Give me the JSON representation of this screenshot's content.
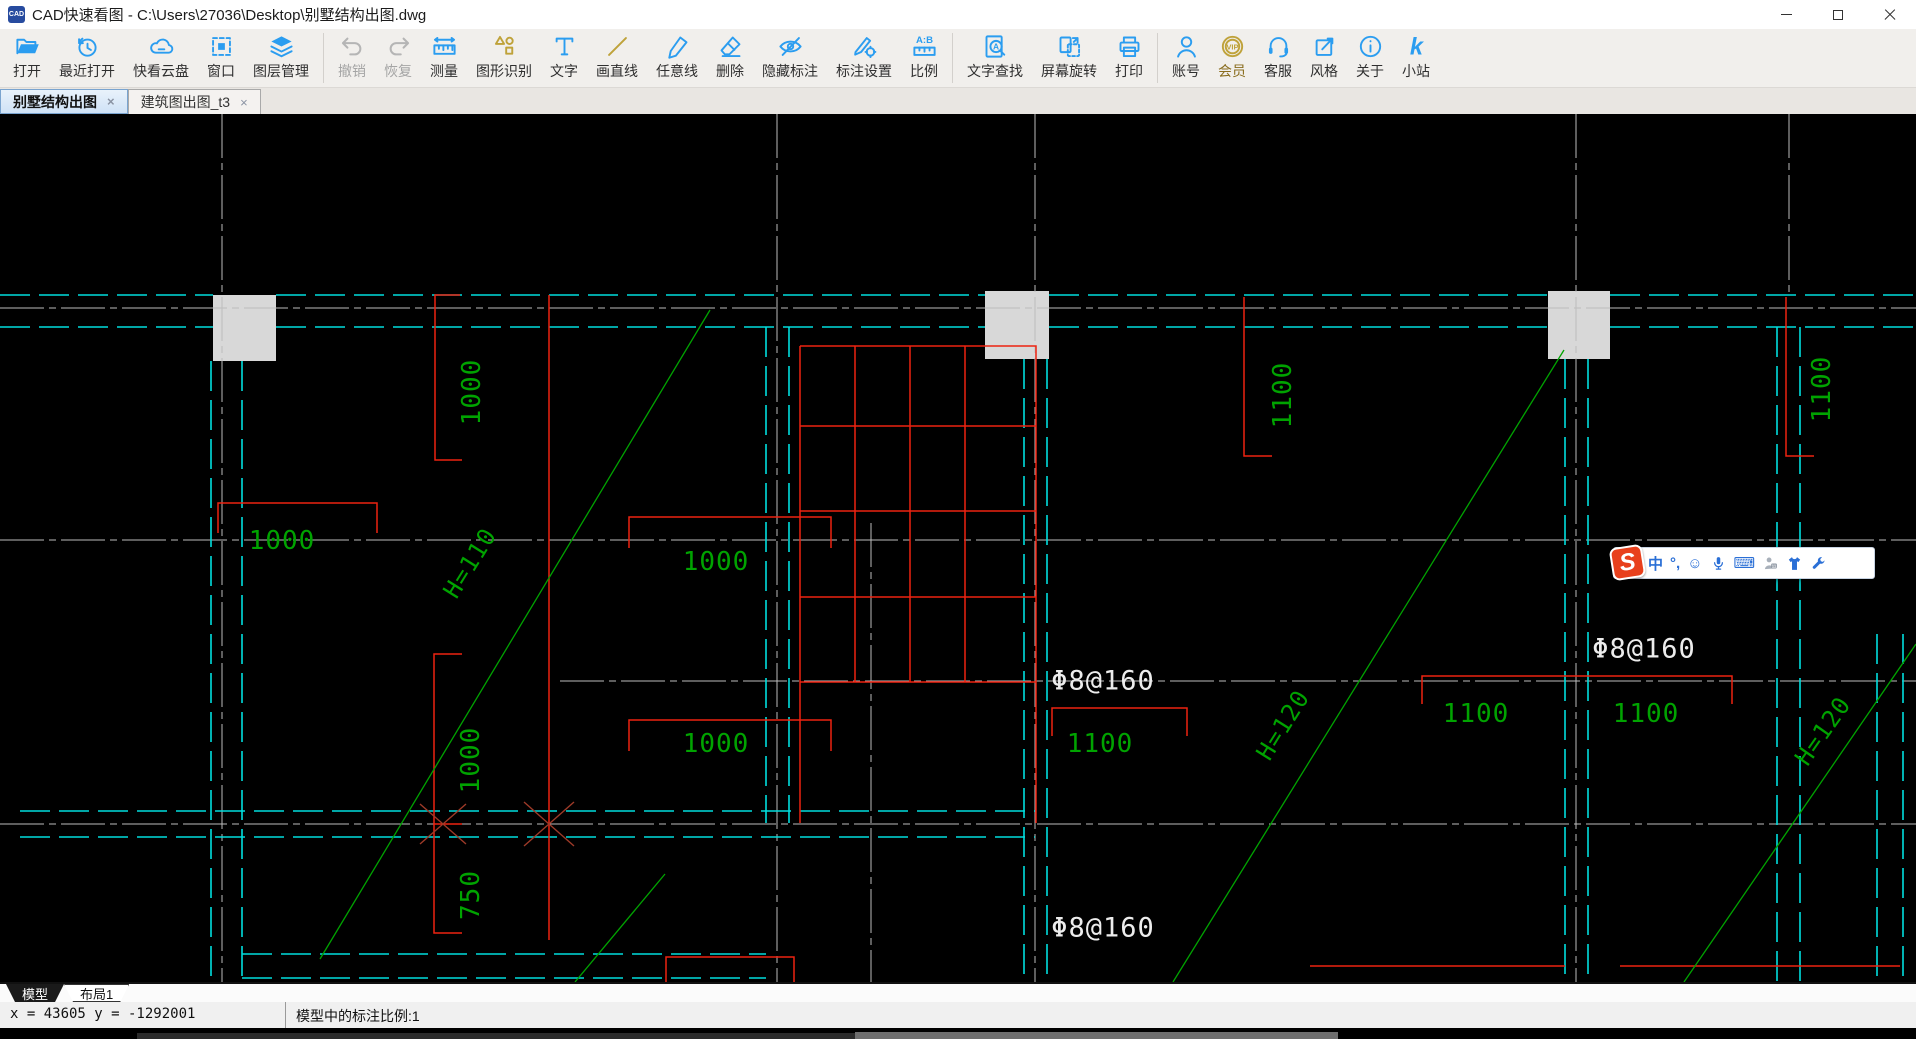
{
  "window": {
    "title": "CAD快速看图 - C:\\Users\\27036\\Desktop\\别墅结构出图.dwg",
    "app_icon_text": "CAD"
  },
  "toolbar": {
    "items": [
      {
        "label": "打开"
      },
      {
        "label": "最近打开"
      },
      {
        "label": "快看云盘"
      },
      {
        "label": "窗口"
      },
      {
        "label": "图层管理"
      },
      {
        "label": "撤销",
        "disabled": true
      },
      {
        "label": "恢复",
        "disabled": true
      },
      {
        "label": "测量"
      },
      {
        "label": "图形识别"
      },
      {
        "label": "文字"
      },
      {
        "label": "画直线"
      },
      {
        "label": "任意线"
      },
      {
        "label": "删除"
      },
      {
        "label": "隐藏标注"
      },
      {
        "label": "标注设置"
      },
      {
        "label": "比例"
      },
      {
        "label": "文字查找"
      },
      {
        "label": "屏幕旋转"
      },
      {
        "label": "打印"
      },
      {
        "label": "账号"
      },
      {
        "label": "会员",
        "gold": true
      },
      {
        "label": "客服"
      },
      {
        "label": "风格"
      },
      {
        "label": "关于"
      },
      {
        "label": "小站"
      }
    ],
    "vip_badge": "VIP",
    "scale_icon_text": "A:B",
    "site_icon_text": "k"
  },
  "doc_tabs": [
    {
      "label": "别墅结构出图",
      "active": true
    },
    {
      "label": "建筑图出图_t3",
      "active": false
    }
  ],
  "ui_glyphs": {
    "tab_close": "×"
  },
  "ime_bar": {
    "logo_text": "S",
    "mode_label": "中",
    "punctuation_label": "°,",
    "emoji_glyph": "☺",
    "keyboard_glyph": "⌨"
  },
  "sheet_tabs": [
    {
      "label": "模型",
      "active": true
    },
    {
      "label": "布局1",
      "active": false
    }
  ],
  "status_bar": {
    "coordinates": "x = 43605 y = -1292001",
    "scale_info": "模型中的标注比例:1"
  },
  "colors": {
    "icon_blue": "#2b9df0",
    "gold": "#bfa23a",
    "cad_green": "#00a300",
    "cad_cyan": "#00dede",
    "cad_red": "#ee2211",
    "cad_white": "#ececec"
  },
  "canvas": {
    "labels": [
      {
        "text": "1000",
        "x": 472,
        "y": 278,
        "rot": -90,
        "color": "#00a300",
        "size": 26,
        "name": "dim-label"
      },
      {
        "text": "1000",
        "x": 282,
        "y": 427,
        "rot": 0,
        "color": "#00a300",
        "size": 26,
        "name": "dim-label"
      },
      {
        "text": "1000",
        "x": 716,
        "y": 448,
        "rot": 0,
        "color": "#00a300",
        "size": 26,
        "name": "dim-label"
      },
      {
        "text": "1000",
        "x": 716,
        "y": 630,
        "rot": 0,
        "color": "#00a300",
        "size": 26,
        "name": "dim-label"
      },
      {
        "text": "1000",
        "x": 471,
        "y": 646,
        "rot": -90,
        "color": "#00a300",
        "size": 26,
        "name": "dim-label"
      },
      {
        "text": "750",
        "x": 471,
        "y": 781,
        "rot": -90,
        "color": "#00a300",
        "size": 26,
        "name": "dim-label"
      },
      {
        "text": "1100",
        "x": 1283,
        "y": 281,
        "rot": -90,
        "color": "#00a300",
        "size": 26,
        "name": "dim-label"
      },
      {
        "text": "1822",
        "x": 1822,
        "y": 275,
        "rot": -90,
        "color": "#00a300",
        "size": 26,
        "name": "dim-label",
        "t": "1100"
      },
      {
        "text": "1100",
        "x": 1100,
        "y": 630,
        "rot": 0,
        "color": "#00a300",
        "size": 26,
        "name": "dim-label"
      },
      {
        "text": "1100",
        "x": 1476,
        "y": 600,
        "rot": 0,
        "color": "#00a300",
        "size": 26,
        "name": "dim-label"
      },
      {
        "text": "1100",
        "x": 1646,
        "y": 600,
        "rot": 0,
        "color": "#00a300",
        "size": 26,
        "name": "dim-label"
      },
      {
        "text": "Φ8@160",
        "x": 1103,
        "y": 567,
        "rot": 0,
        "color": "#ececec",
        "size": 27,
        "name": "rebar-label"
      },
      {
        "text": "Φ8@160",
        "x": 1644,
        "y": 535,
        "rot": 0,
        "color": "#ececec",
        "size": 27,
        "name": "rebar-label"
      },
      {
        "text": "Φ8@160",
        "x": 1103,
        "y": 814,
        "rot": 0,
        "color": "#ececec",
        "size": 27,
        "name": "rebar-label"
      },
      {
        "text": "H=110",
        "x": 470,
        "y": 449,
        "rot": -58,
        "color": "#00a300",
        "size": 24,
        "name": "height-label"
      },
      {
        "text": "H=120",
        "x": 1283,
        "y": 611,
        "rot": -58,
        "color": "#00a300",
        "size": 24,
        "name": "height-label"
      },
      {
        "text": "H=120",
        "x": 1823,
        "y": 617,
        "rot": -55,
        "color": "#00a300",
        "size": 24,
        "name": "height-label"
      }
    ]
  }
}
